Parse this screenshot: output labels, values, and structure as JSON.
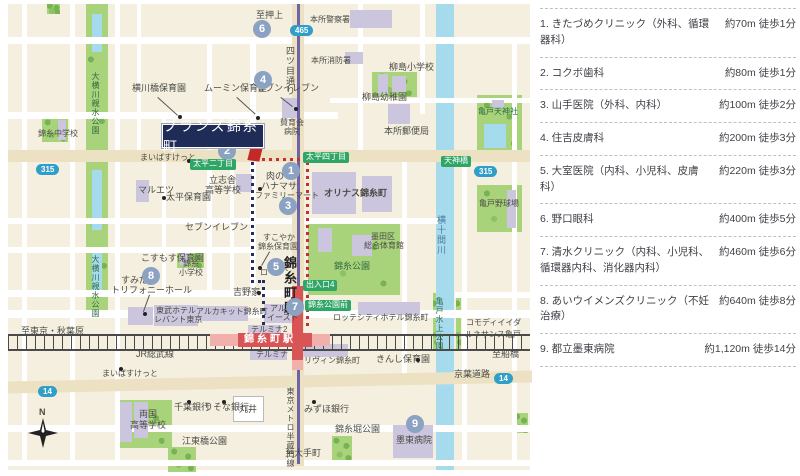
{
  "facilities": {
    "items": [
      {
        "label": "1. きたづめクリニック（外科、循環器科）",
        "distance": "約70m 徒歩1分"
      },
      {
        "label": "2. コクボ歯科",
        "distance": "約80m 徒歩1分"
      },
      {
        "label": "3. 山手医院（外科、内科）",
        "distance": "約100m 徒歩2分"
      },
      {
        "label": "4. 住吉皮膚科",
        "distance": "約200m 徒歩3分"
      },
      {
        "label": "5. 大室医院（内科、小児科、皮膚科）",
        "distance": "約220m 徒歩3分"
      },
      {
        "label": "6. 野口眼科",
        "distance": "約400m 徒歩5分"
      },
      {
        "label": "7. 清水クリニック（内科、小児科、循環器内科、消化器内科）",
        "distance": "約460m 徒歩6分"
      },
      {
        "label": "8. あいウイメンズクリニック（不妊治療）",
        "distance": "約640m 徒歩8分"
      },
      {
        "label": "9. 都立墨東病院",
        "distance": "約1,120m 徒歩14分"
      }
    ]
  },
  "map": {
    "property_label": "ブランズ錦糸町",
    "labels": [
      {
        "t": "至押上",
        "x": 256,
        "y": 11
      },
      {
        "t": "本所警察署",
        "x": 310,
        "y": 16,
        "c": "s8"
      },
      {
        "t": "本所消防署",
        "x": 311,
        "y": 57,
        "c": "s8"
      },
      {
        "t": "四ツ目通り",
        "x": 285,
        "y": 46,
        "c": "v"
      },
      {
        "t": "柳島小学校",
        "x": 389,
        "y": 63
      },
      {
        "t": "柳島幼稚園",
        "x": 362,
        "y": 93
      },
      {
        "t": "本所郵便局",
        "x": 384,
        "y": 127
      },
      {
        "t": "亀戸天神社",
        "x": 478,
        "y": 108,
        "c": "grn s8"
      },
      {
        "t": "横川橋保育園",
        "x": 132,
        "y": 84
      },
      {
        "t": "ムーミン保育室",
        "x": 204,
        "y": 84
      },
      {
        "t": "セブンイレブン",
        "x": 256,
        "y": 84
      },
      {
        "t": "賛育会",
        "x": 280,
        "y": 119,
        "c": "s8"
      },
      {
        "t": "病院",
        "x": 284,
        "y": 128,
        "c": "s8"
      },
      {
        "t": "まいばすけっと",
        "x": 140,
        "y": 154,
        "c": "s8"
      },
      {
        "t": "マルエツ",
        "x": 138,
        "y": 186
      },
      {
        "t": "太平保育園",
        "x": 166,
        "y": 193
      },
      {
        "t": "立志舎",
        "x": 209,
        "y": 176
      },
      {
        "t": "高等学校",
        "x": 205,
        "y": 186
      },
      {
        "t": "肉の",
        "x": 266,
        "y": 172
      },
      {
        "t": "ハナマサ",
        "x": 261,
        "y": 182
      },
      {
        "t": "ファミリーマート",
        "x": 255,
        "y": 192,
        "c": "s8"
      },
      {
        "t": "セブンイレブン",
        "x": 185,
        "y": 223
      },
      {
        "t": "こすもす保育園",
        "x": 141,
        "y": 254
      },
      {
        "t": "すこやか",
        "x": 263,
        "y": 234,
        "c": "s8"
      },
      {
        "t": "錦糸保育園",
        "x": 258,
        "y": 243,
        "c": "s8"
      },
      {
        "t": "ローソン",
        "x": 260,
        "y": 269,
        "c": "s8"
      },
      {
        "t": "錦糸",
        "x": 183,
        "y": 260,
        "c": "s8"
      },
      {
        "t": "小学校",
        "x": 179,
        "y": 269,
        "c": "s8"
      },
      {
        "t": "吉野家",
        "x": 233,
        "y": 288
      },
      {
        "t": "オリナス錦糸町",
        "x": 324,
        "y": 189,
        "c": "b"
      },
      {
        "t": "墨田区",
        "x": 371,
        "y": 233,
        "c": "s8"
      },
      {
        "t": "総合体育館",
        "x": 364,
        "y": 242,
        "c": "s8"
      },
      {
        "t": "錦糸公園",
        "x": 334,
        "y": 262,
        "c": "grn"
      },
      {
        "t": "横十間川",
        "x": 436,
        "y": 215,
        "c": "v wtr"
      },
      {
        "t": "亀戸野球場",
        "x": 479,
        "y": 200,
        "c": "s8"
      },
      {
        "t": "大横川親水公園",
        "x": 91,
        "y": 72,
        "c": "v grn s8"
      },
      {
        "t": "大横川親水公園",
        "x": 91,
        "y": 255,
        "c": "v grn s8"
      },
      {
        "t": "錦糸中学校",
        "x": 38,
        "y": 130,
        "c": "s8"
      },
      {
        "t": "すみだ",
        "x": 121,
        "y": 276
      },
      {
        "t": "トリフォニーホール",
        "x": 111,
        "y": 286
      },
      {
        "t": "東武ホテル",
        "x": 156,
        "y": 307,
        "c": "s8"
      },
      {
        "t": "レバント東京",
        "x": 154,
        "y": 316,
        "c": "s8"
      },
      {
        "t": "アルカキット錦糸町",
        "x": 196,
        "y": 308,
        "c": "s8"
      },
      {
        "t": "アルカ",
        "x": 270,
        "y": 305,
        "c": "s8"
      },
      {
        "t": "イースト",
        "x": 267,
        "y": 314,
        "c": "s8"
      },
      {
        "t": "テルミナ2",
        "x": 251,
        "y": 326,
        "c": "s8"
      },
      {
        "t": "テルミナ",
        "x": 256,
        "y": 351,
        "c": "s8"
      },
      {
        "t": "錦糸町駅",
        "x": 283,
        "y": 256,
        "c": "v vbig"
      },
      {
        "t": "錦糸町駅",
        "x": 244,
        "y": 335,
        "c": "st"
      },
      {
        "t": "リヴィン錦糸町",
        "x": 304,
        "y": 357,
        "c": "s8"
      },
      {
        "t": "ロッテシティホテル錦糸町",
        "x": 333,
        "y": 314,
        "c": "s8"
      },
      {
        "t": "きんし保育園",
        "x": 376,
        "y": 355
      },
      {
        "t": "コモディイイダ",
        "x": 466,
        "y": 319,
        "c": "s8"
      },
      {
        "t": "ルネサンス亀戸",
        "x": 465,
        "y": 331,
        "c": "s8"
      },
      {
        "t": "至船橋",
        "x": 492,
        "y": 350
      },
      {
        "t": "京葉道路",
        "x": 454,
        "y": 370
      },
      {
        "t": "亀戸水上公園",
        "x": 435,
        "y": 297,
        "c": "v grn s8"
      },
      {
        "t": "JR総武線",
        "x": 136,
        "y": 350
      },
      {
        "t": "至東京・秋葉原",
        "x": 21,
        "y": 327
      },
      {
        "t": "まいばすけっと",
        "x": 102,
        "y": 370,
        "c": "s8"
      },
      {
        "t": "千葉銀行",
        "x": 174,
        "y": 403
      },
      {
        "t": "りそな銀行",
        "x": 204,
        "y": 403
      },
      {
        "t": "丸井",
        "x": 239,
        "y": 405
      },
      {
        "t": "みずほ銀行",
        "x": 304,
        "y": 405
      },
      {
        "t": "両国",
        "x": 139,
        "y": 410
      },
      {
        "t": "高等学校",
        "x": 130,
        "y": 421
      },
      {
        "t": "江東橋公園",
        "x": 182,
        "y": 437
      },
      {
        "t": "錦糸堀公園",
        "x": 335,
        "y": 425
      },
      {
        "t": "墨東病院",
        "x": 396,
        "y": 436
      },
      {
        "t": "東京メトロ半蔵門線",
        "x": 286,
        "y": 387,
        "c": "v s8"
      },
      {
        "t": "至大手町",
        "x": 285,
        "y": 449
      },
      {
        "t": "N",
        "x": 39,
        "y": 408,
        "c": "b"
      }
    ],
    "circles": [
      {
        "n": "1",
        "x": 291,
        "y": 171
      },
      {
        "n": "2",
        "x": 227,
        "y": 151
      },
      {
        "n": "3",
        "x": 288,
        "y": 206
      },
      {
        "n": "4",
        "x": 263,
        "y": 80
      },
      {
        "n": "5",
        "x": 276,
        "y": 267
      },
      {
        "n": "6",
        "x": 262,
        "y": 29
      },
      {
        "n": "7",
        "x": 295,
        "y": 307
      },
      {
        "n": "8",
        "x": 151,
        "y": 276
      },
      {
        "n": "9",
        "x": 415,
        "y": 424
      }
    ],
    "green_badges": [
      {
        "t": "太平二丁目",
        "x": 190,
        "y": 159
      },
      {
        "t": "太平四丁目",
        "x": 303,
        "y": 152
      },
      {
        "t": "天神橋",
        "x": 441,
        "y": 156
      },
      {
        "t": "出入口4",
        "x": 303,
        "y": 280
      },
      {
        "t": "錦糸公園前",
        "x": 305,
        "y": 300
      }
    ],
    "route_badges": [
      {
        "t": "315",
        "x": 36,
        "y": 164
      },
      {
        "t": "465",
        "x": 290,
        "y": 25
      },
      {
        "t": "315",
        "x": 474,
        "y": 166
      },
      {
        "t": "14",
        "x": 38,
        "y": 386
      },
      {
        "t": "14",
        "x": 494,
        "y": 373
      }
    ],
    "dots": [
      [
        178,
        115
      ],
      [
        256,
        116
      ],
      [
        294,
        107
      ],
      [
        187,
        159
      ],
      [
        162,
        196
      ],
      [
        258,
        187
      ],
      [
        258,
        266
      ],
      [
        257,
        291
      ],
      [
        416,
        358
      ],
      [
        119,
        367
      ],
      [
        187,
        400
      ],
      [
        222,
        400
      ],
      [
        312,
        400
      ],
      [
        143,
        312
      ]
    ]
  },
  "colors": {
    "property_navy": "#1f2c58",
    "marker_red": "#c62828",
    "circle_blue": "#8ca2c2",
    "badge_green": "#2fa566",
    "route_badge_blue": "#2f9ec9",
    "park_green": "#a9d37b",
    "water_blue": "#a6dbee",
    "building_lavender": "#cbc5de",
    "station_red": "#d95555",
    "metro_purple": "#6f63a8",
    "map_bg": "#f4efdf"
  }
}
